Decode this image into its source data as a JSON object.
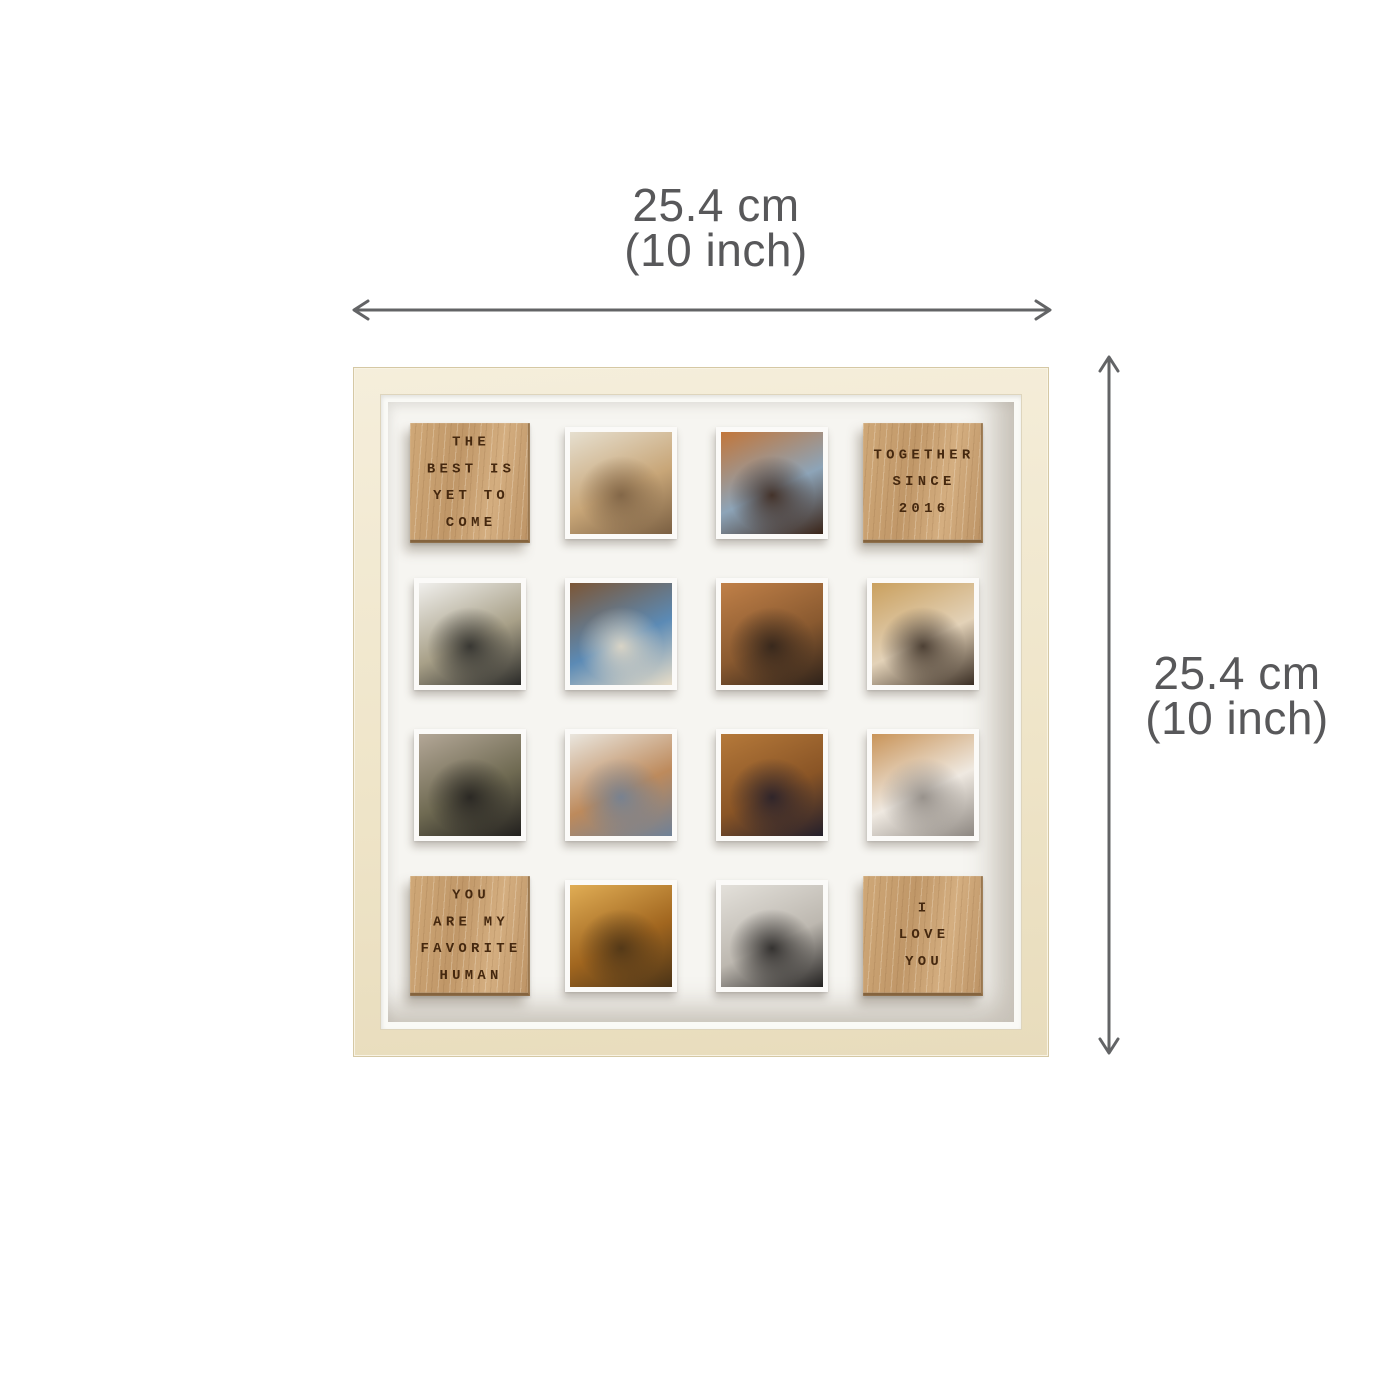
{
  "product": {
    "name": "personalized-photo-collage-frame"
  },
  "dimension_labels": {
    "width": {
      "cm": "25.4 cm",
      "inch": "(10 inch)"
    },
    "height": {
      "cm": "25.4 cm",
      "inch": "(10 inch)"
    }
  },
  "colors": {
    "background": "#ffffff",
    "label_text": "#58585a",
    "arrow": "#636466",
    "frame_wood": "#efe5c9",
    "frame_edge": "#d5c8a4",
    "mat": "#f6f5f1",
    "oak": "#c79f70",
    "oak_edge": "#85643e",
    "oak_text": "#45280f",
    "photo_border": "#fbfaf8"
  },
  "frame": {
    "tiles": [
      {
        "type": "wood",
        "id": "wood-quote-best-yet-to-come",
        "lines": [
          "THE",
          "BEST IS",
          "YET TO",
          "COME"
        ]
      },
      {
        "type": "photo",
        "id": "photo-couple-walking-desert",
        "desc": "couple walking on sandy cliffs",
        "colors": [
          "#e6dfcf",
          "#c8a678",
          "#7a5f42"
        ]
      },
      {
        "type": "photo",
        "id": "photo-couple-evening-lights",
        "desc": "couple embracing at night with warm bokeh lights",
        "colors": [
          "#c2763a",
          "#8da4b8",
          "#3a2418"
        ]
      },
      {
        "type": "wood",
        "id": "wood-together-since-2016",
        "lines": [
          "TOGETHER",
          "SINCE",
          "2016"
        ]
      },
      {
        "type": "photo",
        "id": "photo-piggyback-snow",
        "desc": "piggyback couple in snow",
        "colors": [
          "#f0efec",
          "#a8a088",
          "#2a2a28"
        ]
      },
      {
        "type": "photo",
        "id": "photo-couple-denim-smiling",
        "desc": "smiling couple, denim jacket, wooden wall",
        "colors": [
          "#7c5636",
          "#5b8ab5",
          "#e8ddc8"
        ]
      },
      {
        "type": "photo",
        "id": "photo-kiss-cheek-autumn",
        "desc": "man kissing woman's cheek, autumn blur",
        "colors": [
          "#c08048",
          "#8a5a30",
          "#2e221a"
        ]
      },
      {
        "type": "photo",
        "id": "photo-couple-autumn-path",
        "desc": "couple in dark coats on autumn path",
        "colors": [
          "#caa05e",
          "#e3d2b8",
          "#3a2e24"
        ]
      },
      {
        "type": "photo",
        "id": "photo-forehead-kiss-beanie",
        "desc": "forehead kiss, black beanie, olive jackets",
        "colors": [
          "#b3a797",
          "#6f6a52",
          "#22201e"
        ]
      },
      {
        "type": "photo",
        "id": "photo-couple-lifting-indoors",
        "desc": "man lifting woman in camel cardigan, light wall",
        "colors": [
          "#eae6de",
          "#bd8a5c",
          "#6f8197"
        ]
      },
      {
        "type": "photo",
        "id": "photo-piggyback-autumn-forest",
        "desc": "piggyback couple in orange autumn forest",
        "colors": [
          "#b5793a",
          "#8a5526",
          "#241f2b"
        ]
      },
      {
        "type": "photo",
        "id": "photo-couple-dancing-street",
        "desc": "couple dancing on street, white dress, autumn trees",
        "colors": [
          "#c99459",
          "#efe9e1",
          "#8d8781"
        ]
      },
      {
        "type": "wood",
        "id": "wood-you-are-my-favorite-human",
        "lines": [
          "YOU",
          "ARE MY",
          "FAVORITE",
          "HUMAN"
        ]
      },
      {
        "type": "photo",
        "id": "photo-couple-golden-forest",
        "desc": "couple dancing in golden sunlit forest",
        "colors": [
          "#e0ad55",
          "#a1661f",
          "#4a3317"
        ]
      },
      {
        "type": "photo",
        "id": "photo-couple-winter-hug",
        "desc": "winter hug, cream knit beanie, snowy trees",
        "colors": [
          "#e3e0da",
          "#bdb8b0",
          "#232120"
        ]
      },
      {
        "type": "wood",
        "id": "wood-i-love-you",
        "lines": [
          "I",
          "LOVE",
          "YOU"
        ]
      }
    ]
  }
}
